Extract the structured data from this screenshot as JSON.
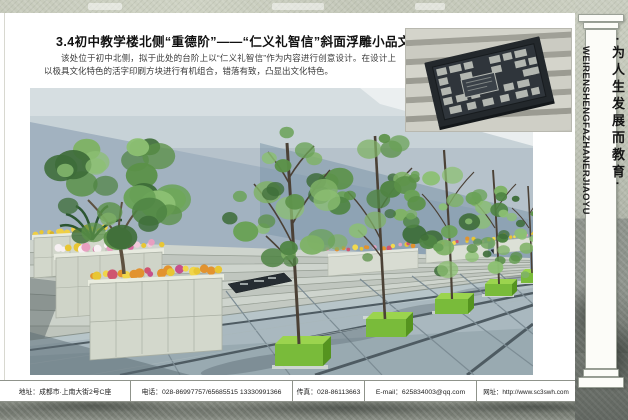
{
  "header": {
    "title": "3.4初中教学楼北侧“重德阶”——“仁义礼智信”斜面浮雕小品文化",
    "paragraph": "该处位于初中北侧，拟于此处的台阶上以“仁义礼智信”作为内容进行创意设计。在设计上以极具文化特色的活字印刷方块进行有机组合，错落有致，凸显出文化特色。"
  },
  "sidebar": {
    "slogan_cn": "·为人生发展而教育·",
    "slogan_en": "WEIRENSHENGFAZHANERJIAOYU"
  },
  "footer": {
    "items": [
      "地址：成都市·上南大街2号C座",
      "电话：028-86997757/65685515  13330991366",
      "传真：028-86113663",
      "E-mail：625834003@qq.com",
      "网址：http://www.sc3swh.com"
    ]
  },
  "colors": {
    "frame_texture": "#c6cabb",
    "frame_dark": "#6e736b",
    "sky": "#b6c2cb",
    "wall": "#a2b2c0",
    "pavement": "#a9b8bf",
    "grass_cube": "#79bb3a",
    "plaque": "#23282c"
  }
}
